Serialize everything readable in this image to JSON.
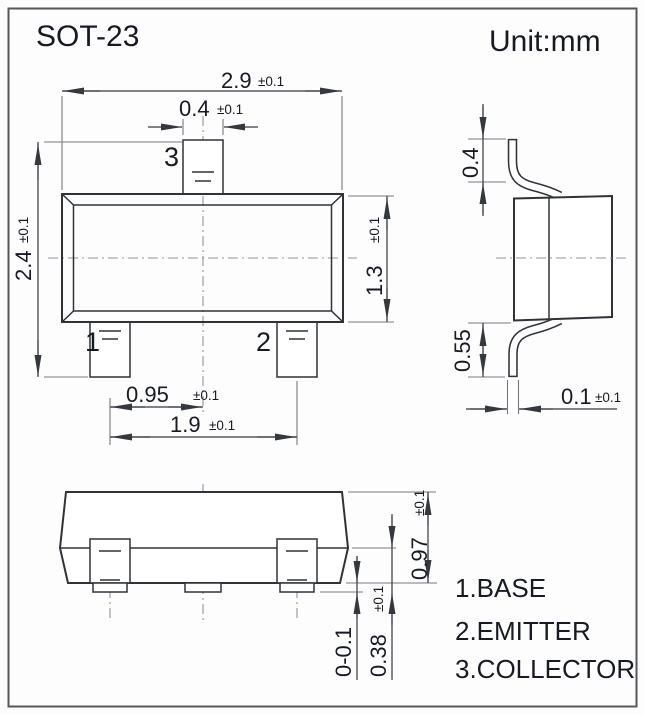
{
  "title": "SOT-23",
  "unit_label": "Unit:mm",
  "colors": {
    "line": "#2f3338",
    "dimension_line": "#35393e",
    "extension_line": "#75797e",
    "centerline": "#8f959a",
    "text": "#171a22",
    "background": "#ffffff"
  },
  "pin_labels": {
    "pin1": "1",
    "pin2": "2",
    "pin3": "3"
  },
  "legend": [
    "1.BASE",
    "2.EMITTER",
    "3.COLLECTOR"
  ],
  "dimensions": {
    "body_width": {
      "value": "2.9",
      "tol": "±0.1"
    },
    "pin3_width": {
      "value": "0.4",
      "tol": "±0.1"
    },
    "body_height": {
      "value": "2.4",
      "tol": "±0.1"
    },
    "body_depth": {
      "value": "1.3",
      "tol": "±0.1"
    },
    "pin_pitch_half": {
      "value": "0.95",
      "tol": "±0.1"
    },
    "pin_pitch": {
      "value": "1.9",
      "tol": "±0.1"
    },
    "lead_top_height": {
      "value": "0.4",
      "tol": ""
    },
    "lead_bottom_height": {
      "value": "0.55",
      "tol": ""
    },
    "lead_thickness": {
      "value": "0.1",
      "tol": "±0.1"
    },
    "front_body_height": {
      "value": "0.97",
      "tol": "±0.1"
    },
    "lead_foot_height": {
      "value": "0.38",
      "tol": "±0.1"
    },
    "standoff": {
      "value": "0-0.1",
      "tol": ""
    }
  }
}
